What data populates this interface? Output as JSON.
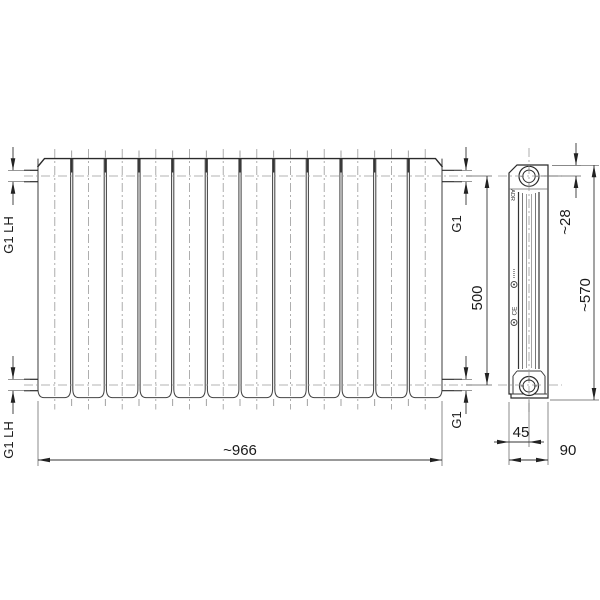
{
  "drawing_title": "panel-radiator-technical-drawing",
  "front_view": {
    "section_count": 12
  },
  "dims": {
    "top_left": "G1 LH",
    "bottom_left": "G1 LH",
    "top_right": "G1",
    "bottom_right": "G1",
    "height_500": "500",
    "width_966": "~966",
    "depth_28": "~28",
    "height_570": "~570",
    "offset_45": "45",
    "depth_90": "90"
  },
  "markings": {
    "adr": "ADR",
    "ce": "CE"
  },
  "colors": {
    "outline": "#2a2a2a",
    "section_line": "#454545",
    "centerline": "#9a9a9a",
    "extension_line": "#5a5a5a",
    "background": "#ffffff"
  }
}
